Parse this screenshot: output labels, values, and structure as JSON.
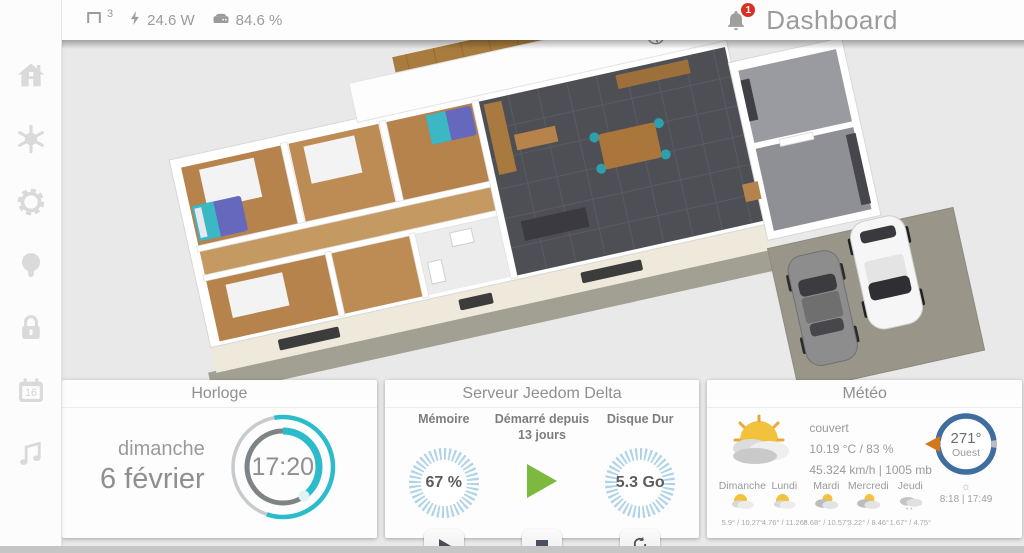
{
  "topbar": {
    "devices_count": "3",
    "power": "24.6 W",
    "disk_usage": "84.6 %",
    "notifications_count": "1",
    "title": "Dashboard"
  },
  "sidebar": {
    "calendar_day": "16"
  },
  "cards": {
    "horloge": {
      "title": "Horloge",
      "day": "dimanche",
      "date": "6 février",
      "time": "17:20"
    },
    "serveur": {
      "title": "Serveur Jeedom Delta",
      "memory_label": "Mémoire",
      "memory_value": "67 %",
      "uptime_label": "Démarré depuis",
      "uptime_value": "13 jours",
      "disk_label": "Disque Dur",
      "disk_value": "5.3 Go"
    },
    "meteo": {
      "title": "Météo",
      "condition": "couvert",
      "temp_humidity": "10.19 °C / 83 %",
      "wind_pressure": "45.324 km/h | 1005 mb",
      "days": [
        {
          "name": "Dimanche",
          "temps": "5.9° / 10.27°"
        },
        {
          "name": "Lundi",
          "temps": "4.76° / 11.26°"
        },
        {
          "name": "Mardi",
          "temps": "8.68° / 10.57°"
        },
        {
          "name": "Mercredi",
          "temps": "3.22° / 8.46°"
        },
        {
          "name": "Jeudi",
          "temps": "1.67° / 4.75°"
        }
      ],
      "wind_direction_deg": "271°",
      "wind_direction_label": "Ouest",
      "sun_times": "8:18 | 17:49"
    }
  },
  "colors": {
    "accent_teal": "#2bbccb",
    "gauge_blue": "#aed3e8",
    "compass_blue": "#3e6d9e",
    "arrow_orange": "#d2771e",
    "play_green": "#7cb93e",
    "badge_red": "#d93025"
  }
}
